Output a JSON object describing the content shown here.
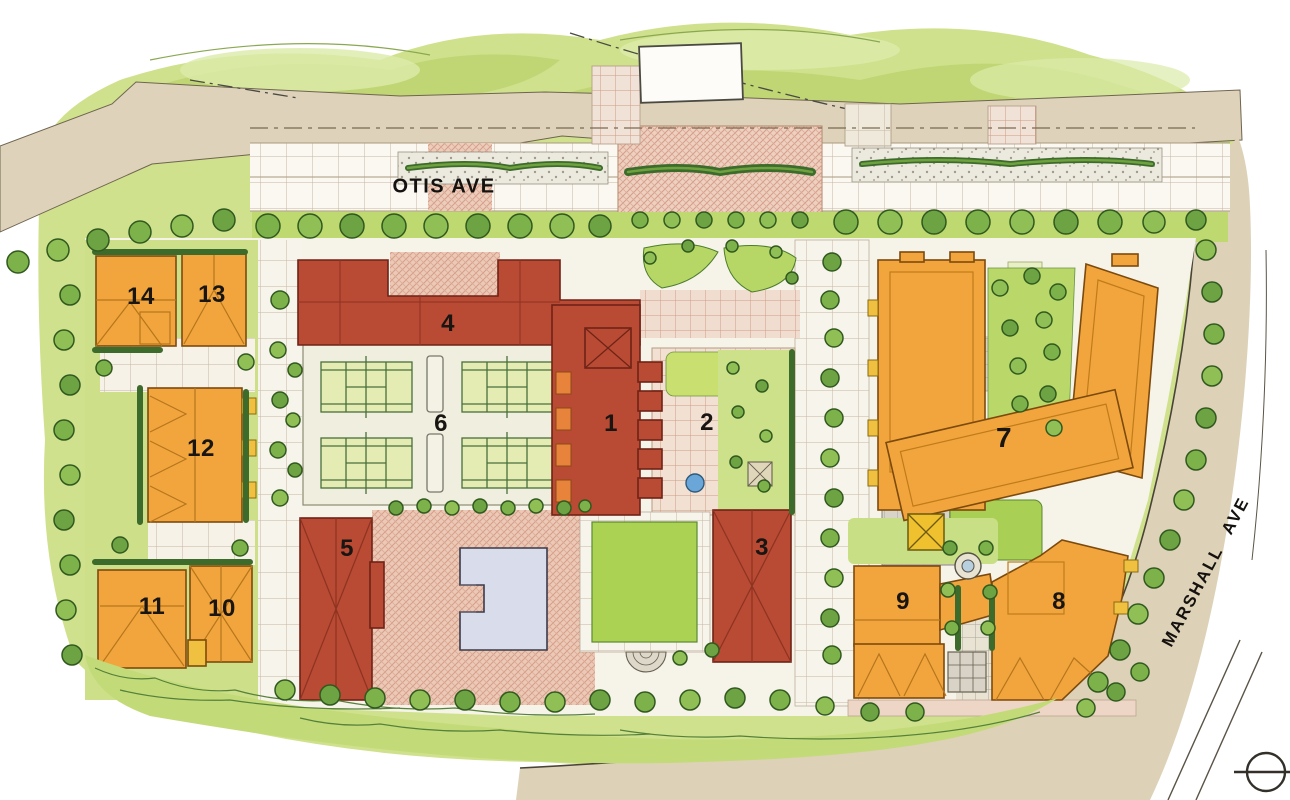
{
  "plan": {
    "kind": "illustrated site master plan",
    "streets": {
      "otis": {
        "label": "OTIS AVE"
      },
      "marshall": {
        "label": "MARSHALL AVE"
      }
    },
    "buildings": {
      "1": {
        "label": "1",
        "fill": "red"
      },
      "2": {
        "label": "2",
        "fill": "paved-courtyard"
      },
      "3": {
        "label": "3",
        "fill": "red"
      },
      "4": {
        "label": "4",
        "fill": "red"
      },
      "5": {
        "label": "5",
        "fill": "red"
      },
      "6": {
        "label": "6",
        "fill": "tennis-court-block"
      },
      "7": {
        "label": "7",
        "fill": "orange"
      },
      "8": {
        "label": "8",
        "fill": "orange"
      },
      "9": {
        "label": "9",
        "fill": "orange"
      },
      "10": {
        "label": "10",
        "fill": "orange"
      },
      "11": {
        "label": "11",
        "fill": "orange"
      },
      "12": {
        "label": "12",
        "fill": "orange"
      },
      "13": {
        "label": "13",
        "fill": "orange"
      },
      "14": {
        "label": "14",
        "fill": "orange"
      }
    },
    "features": {
      "tennis_court_count": 4,
      "swimming_pool": "rectangular pool in paved plaza",
      "central_lawn": "green lawn panel with semicircular steps",
      "fountain": "round fountain between buildings 8 and 9",
      "north_marker": "circle-with-line symbol at bottom right"
    },
    "colors": {
      "red_building": "#b94a33",
      "orange_building": "#f2a53c",
      "lawn_green": "#abd253",
      "site_green": "#cfe18c",
      "paving_pink": "#ebc9b6",
      "road_tan": "#ded3ba",
      "pool_blue": "#d9dcea",
      "tree_green": "#79b24a",
      "label_ink": "#181512"
    }
  }
}
